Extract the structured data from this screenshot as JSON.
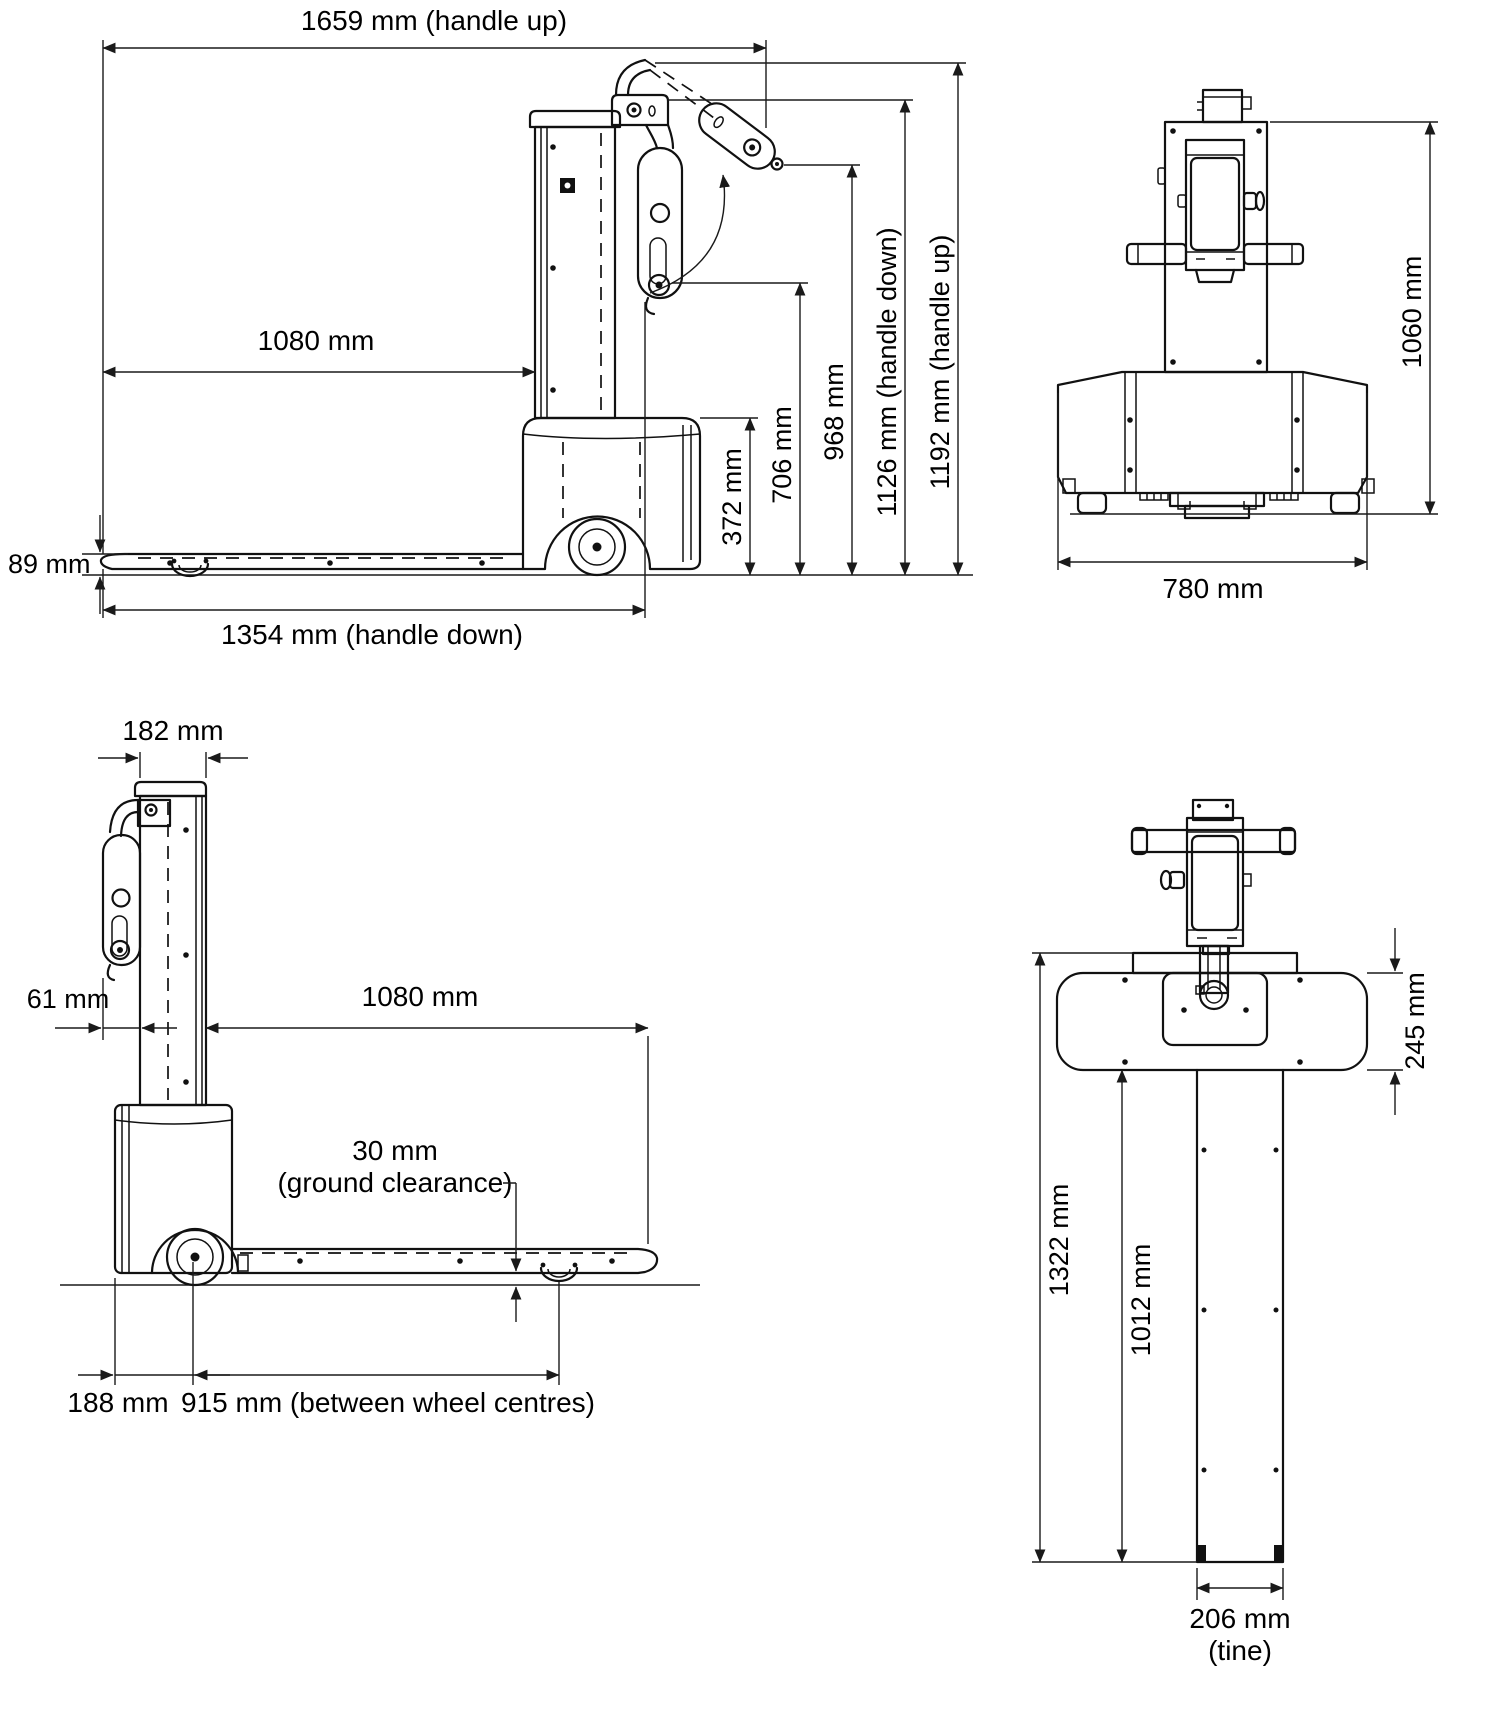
{
  "side_view": {
    "dim_handle_up_length": "1659 mm (handle up)",
    "dim_fork_length": "1080 mm",
    "dim_fork_height": "89 mm",
    "dim_handle_down_length": "1354 mm (handle down)",
    "dim_chassis_height": "372 mm",
    "dim_handle_down_grip_height": "706 mm",
    "dim_handle_pivot_height": "968 mm",
    "dim_height_handle_down": "1126 mm (handle down)",
    "dim_height_handle_up": "1192 mm (handle up)"
  },
  "front_view": {
    "dim_overall_height": "1060 mm",
    "dim_overall_width": "780 mm"
  },
  "rear_side_view": {
    "dim_mast_depth": "182 mm",
    "dim_handle_overhang": "61 mm",
    "dim_fork_length": "1080 mm",
    "dim_ground_clearance_value": "30 mm",
    "dim_ground_clearance_note": "(ground clearance)",
    "dim_rear_overhang": "188 mm",
    "dim_wheelbase": "915 mm (between wheel centres)"
  },
  "top_view": {
    "dim_body_depth": "245 mm",
    "dim_overall_length": "1322 mm",
    "dim_fork_length": "1012 mm",
    "dim_tine_width_value": "206 mm",
    "dim_tine_width_note": "(tine)"
  }
}
